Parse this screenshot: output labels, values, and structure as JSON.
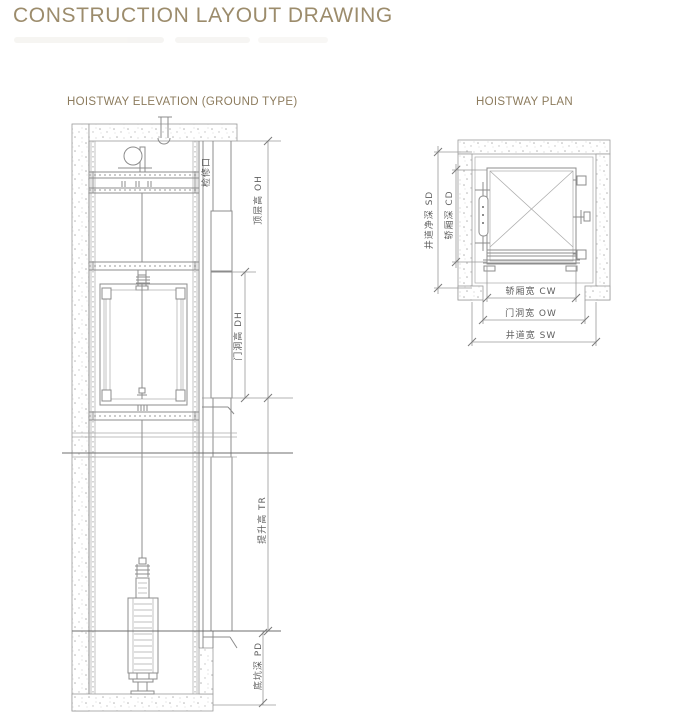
{
  "page": {
    "title": "CONSTRUCTION LAYOUT DRAWING"
  },
  "sections": {
    "elevation": {
      "heading": "HOISTWAY ELEVATION (GROUND TYPE)"
    },
    "plan": {
      "heading": "HOISTWAY PLAN"
    }
  },
  "elevation_labels": {
    "inspection_port": "检修口",
    "overhead": "顶层高  OH",
    "door_height": "门洞高  DH",
    "travel_height": "提升高  TR",
    "pit_depth": "底坑深  PD"
  },
  "plan_labels": {
    "shaft_depth": "井道净深 SD",
    "car_depth": "轿厢深  CD",
    "car_width": "轿厢宽  CW",
    "door_width": "门洞宽  OW",
    "shaft_width": "井道宽  SW"
  },
  "colors": {
    "title": "#9c8c6c",
    "section_heading": "#8d7c5e",
    "drawing_line": "#8c8c8c",
    "dimension_line": "#9a9a9a",
    "label_text": "#5f5f5f",
    "background": "#ffffff"
  }
}
